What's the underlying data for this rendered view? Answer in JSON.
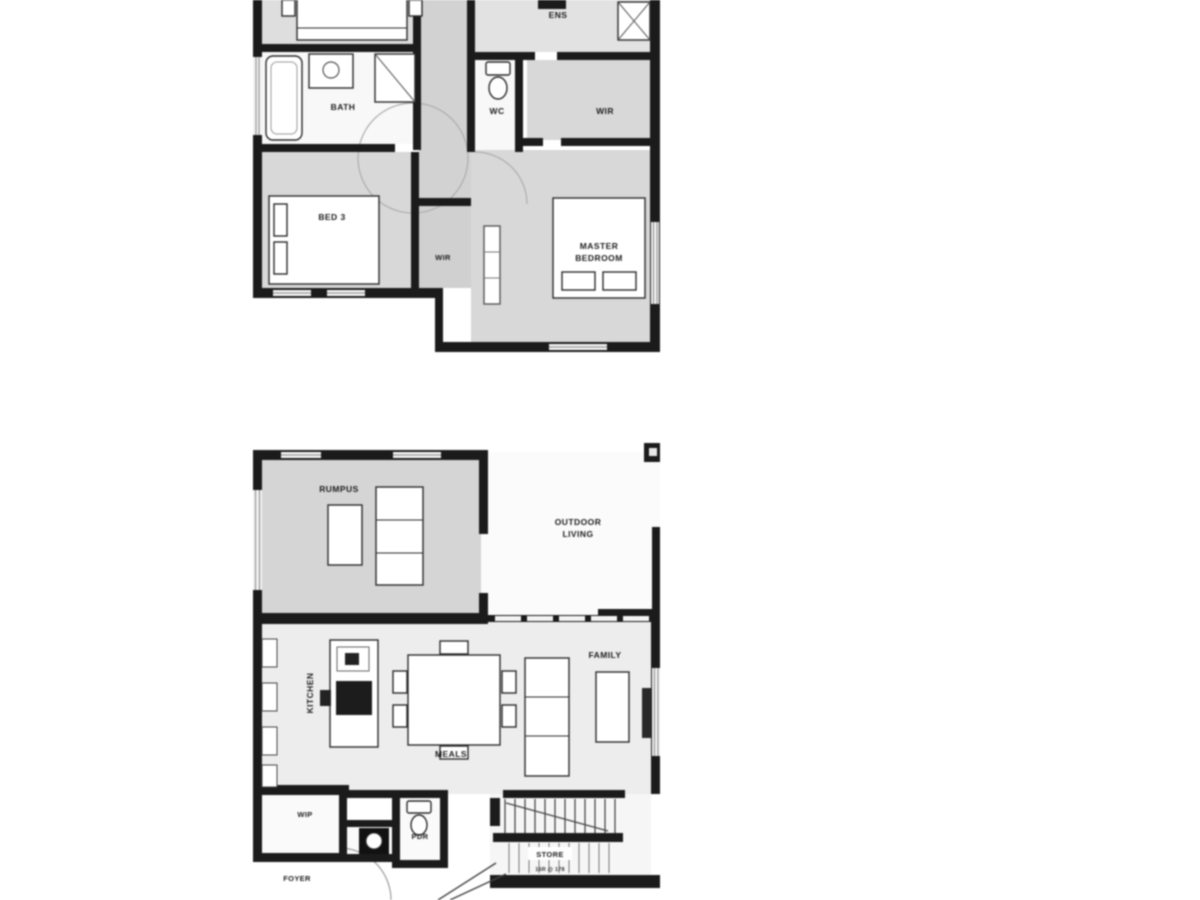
{
  "document": {
    "kind": "architectural floor plan, two levels, scanned low-resolution"
  },
  "colors": {
    "wall": "#1b1b1b",
    "room_grey": "#d7d7d7",
    "room_light": "#ededed",
    "paper": "#ffffff"
  },
  "upper_floor": {
    "labels": {
      "ens": "ENS",
      "bath": "BATH",
      "wc": "WC",
      "wir": "WIR",
      "bed3": "BED 3",
      "wir2": "WIR",
      "master_line1": "MASTER",
      "master_line2": "BEDROOM"
    }
  },
  "ground_floor": {
    "labels": {
      "rumpus": "RUMPUS",
      "outdoor_line1": "OUTDOOR",
      "outdoor_line2": "LIVING",
      "kitchen": "KITCHEN",
      "meals": "MEALS",
      "family": "FAMILY",
      "wip": "WIP",
      "pdr": "PDR",
      "foyer": "FOYER",
      "store": "STORE",
      "stair_note": "16R @ 178"
    }
  }
}
